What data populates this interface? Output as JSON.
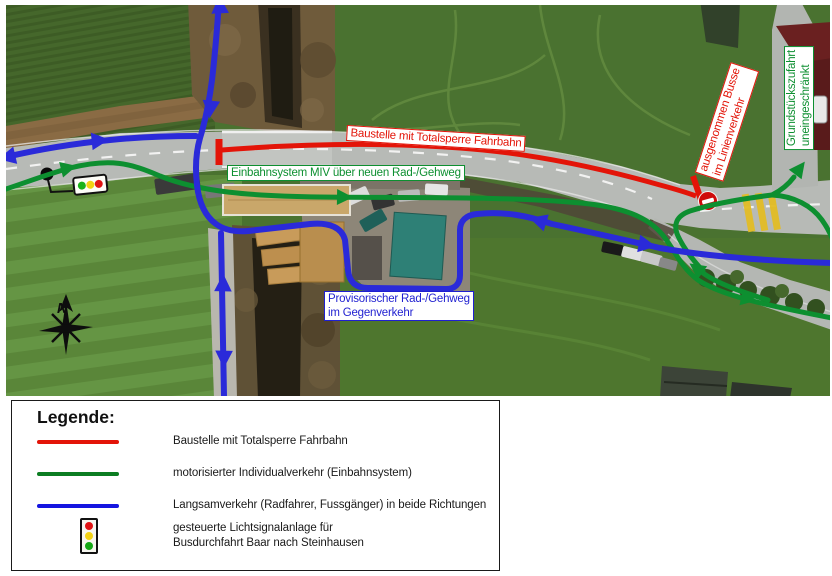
{
  "map": {
    "labels": {
      "baustelle": "Baustelle mit Totalsperre Fahrbahn",
      "einbahn": "Einbahnsystem MIV über neuen Rad-/Gehweg",
      "provisorisch_line1": "Provisorischer Rad-/Gehweg",
      "provisorisch_line2": "im Gegenverkehr",
      "busse_line1": "ausgenommen Busse",
      "busse_line2": "im Linienverkehr",
      "grundstueck_line1": "Grundstückszufahrt",
      "grundstueck_line2": "uneingeschränkt",
      "compass_north": "N"
    },
    "icons": [
      "traffic-light-icon",
      "no-entry-icon",
      "compass-rose-icon"
    ]
  },
  "legend": {
    "title": "Legende:",
    "items": [
      {
        "swatch": "red-line-swatch",
        "label": "Baustelle mit Totalsperre Fahrbahn"
      },
      {
        "swatch": "green-line-swatch",
        "label": "motorisierter Individualverkehr (Einbahnsystem)"
      },
      {
        "swatch": "blue-line-swatch",
        "label": "Langsamverkehr (Radfahrer, Fussgänger) in beide Richtungen"
      },
      {
        "swatch": "traffic-light-icon",
        "label": "gesteuerte Lichtsignalanlage für",
        "label2": "Busdurchfahrt Baar nach Steinhausen"
      }
    ]
  },
  "colors": {
    "closure_red": "#e31408",
    "miv_green": "#0d8f30",
    "slow_traffic_blue": "#2a2ad9"
  }
}
